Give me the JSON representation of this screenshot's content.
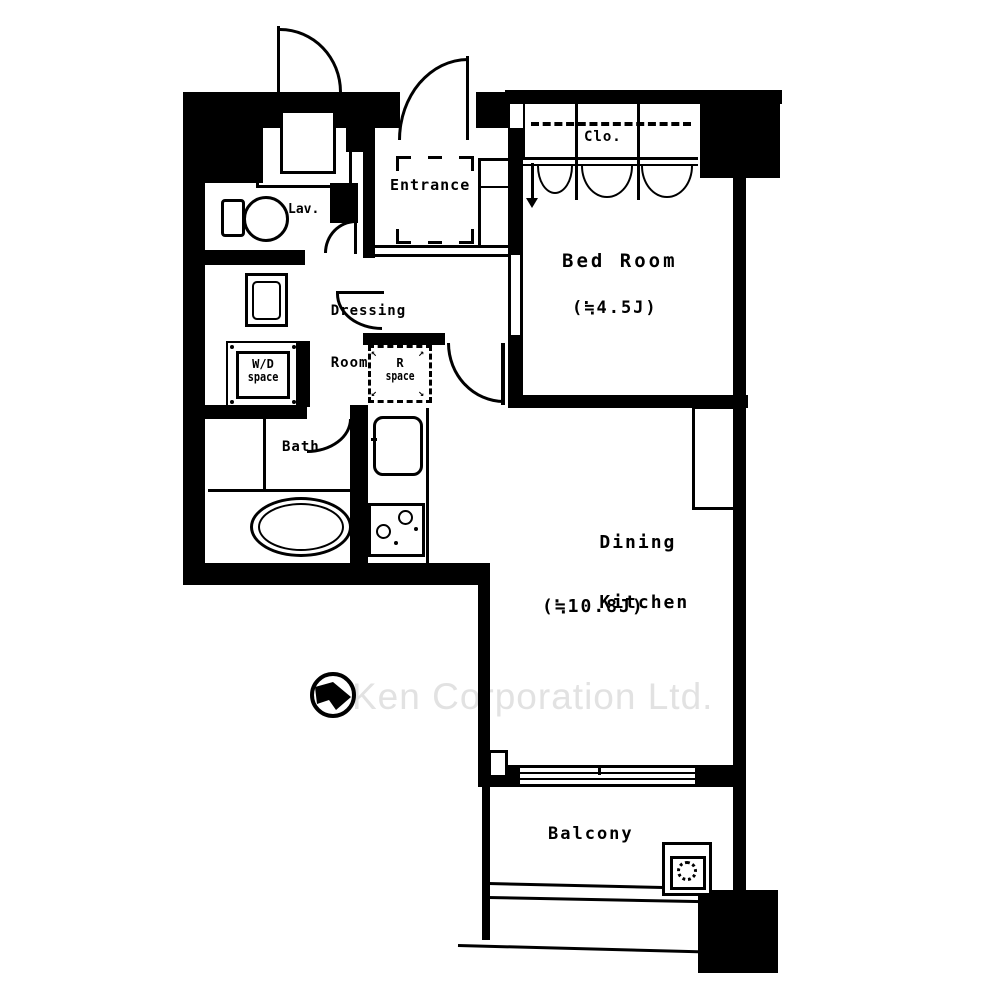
{
  "watermark": {
    "text": "Ken Corporation Ltd."
  },
  "rooms": {
    "entrance": {
      "label": "Entrance"
    },
    "lavatory": {
      "label": "Lav."
    },
    "dressing_room": {
      "label_line1": "Dressing",
      "label_line2": "Room"
    },
    "closet": {
      "label": "Clo."
    },
    "bed_room": {
      "label": "Bed Room",
      "size": "(≒4.5J)"
    },
    "wd_space": {
      "label_line1": "W/D",
      "label_line2": "space"
    },
    "r_space": {
      "label_line1": "R",
      "label_line2": "space"
    },
    "bath": {
      "label": "Bath"
    },
    "dining_kitchen": {
      "label_line1": "Dining",
      "label_line2": "Kitchen",
      "size": "(≒10.8J)"
    },
    "balcony": {
      "label": "Balcony"
    }
  },
  "colors": {
    "line": "#000000",
    "background": "#ffffff",
    "watermark_gray": "#e2e2e2"
  },
  "icons": {
    "compass": "north-compass"
  }
}
